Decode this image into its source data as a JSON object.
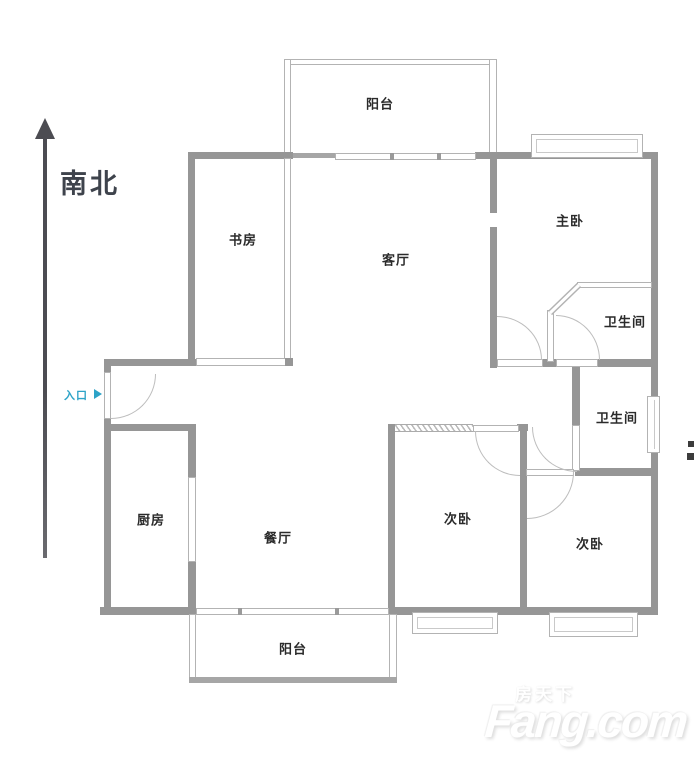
{
  "compass": {
    "direction_label": "南北"
  },
  "entrance": {
    "label": "入口"
  },
  "rooms": [
    {
      "name": "balcony-top",
      "label": "阳台"
    },
    {
      "name": "study",
      "label": "书房"
    },
    {
      "name": "living-room",
      "label": "客厅"
    },
    {
      "name": "master-bedroom",
      "label": "主卧"
    },
    {
      "name": "master-bathroom",
      "label": "卫生间"
    },
    {
      "name": "shared-bathroom",
      "label": "卫生间"
    },
    {
      "name": "kitchen",
      "label": "厨房"
    },
    {
      "name": "dining-room",
      "label": "餐厅"
    },
    {
      "name": "second-bedroom-left",
      "label": "次卧"
    },
    {
      "name": "second-bedroom-right",
      "label": "次卧"
    },
    {
      "name": "balcony-bottom",
      "label": "阳台"
    }
  ],
  "watermark": {
    "brand_cn": "房天下",
    "brand_en": "Fang.com"
  },
  "colors": {
    "wall": "#969696",
    "wall_light": "#b3b3b3",
    "room_text": "#2b2b2b",
    "compass_text": "#3e434c",
    "entrance_accent": "#2da3c7",
    "watermark": "#ffffff",
    "background": "#ffffff"
  }
}
